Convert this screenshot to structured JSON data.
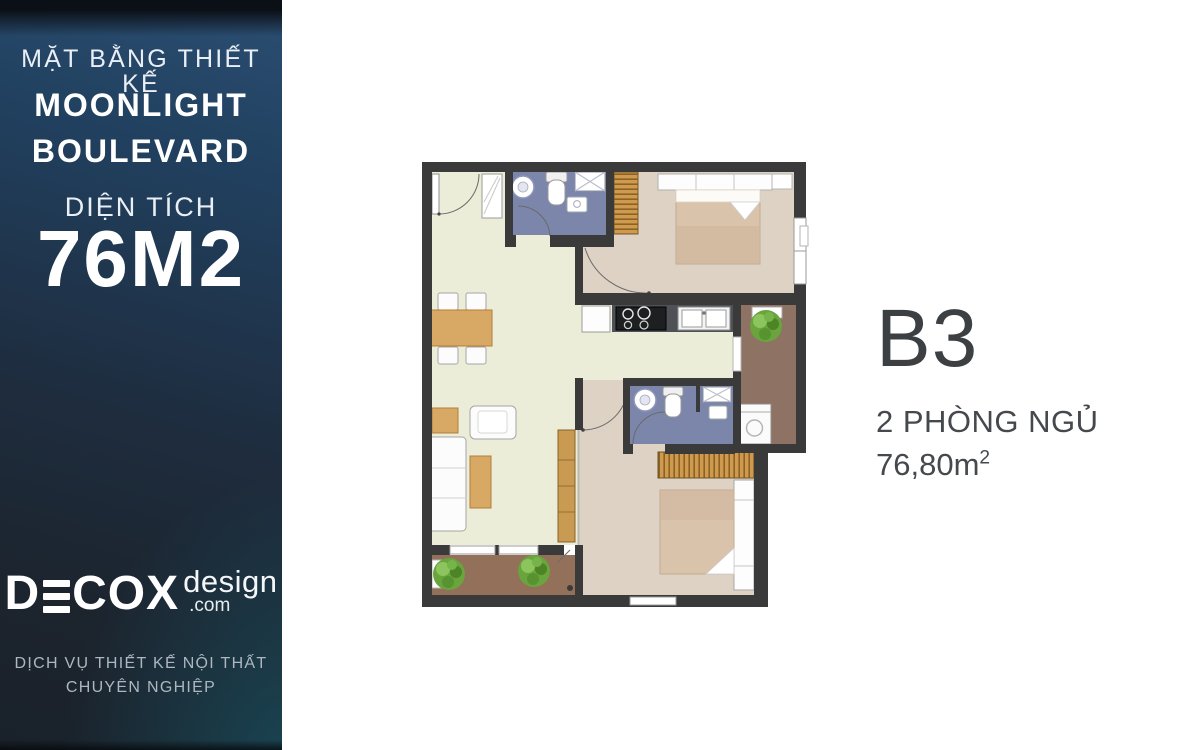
{
  "sidebar": {
    "subtitle": "MẶT BẰNG THIẾT KẾ",
    "title_line1": "MOONLIGHT",
    "title_line2": "BOULEVARD",
    "area_label": "DIỆN TÍCH",
    "area_value": "76M2",
    "logo": {
      "full": "DECOX",
      "part1": "D",
      "part2": "COX",
      "suffix": "design",
      "domain": ".com"
    },
    "tagline_line1": "DỊCH VỤ THIẾT KẾ NỘI THẤT",
    "tagline_line2": "CHUYÊN NGHIỆP",
    "colors": {
      "background_top": "#2b4e72",
      "background_bottom": "#1a212a",
      "teal_glow": "#195f71",
      "text": "#ffffff",
      "tagline_text": "#aeb7bf"
    }
  },
  "unit_info": {
    "code": "B3",
    "bedrooms": "2 PHÒNG NGỦ",
    "area": "76,80m",
    "area_superscript": "2",
    "text_color": "#3e4245"
  },
  "floor_plan": {
    "type": "apartment-2-bedroom-floor-plan",
    "colors": {
      "wall": "#3a3a3a",
      "living_floor": "#ecedd9",
      "bedroom_floor": "#ded2c5",
      "bathroom_floor": "#7c86aa",
      "balcony_floor_left": "#93705a",
      "balcony_floor_right": "#8e7263",
      "wood": "#d2a261",
      "counter": "#4e5257",
      "plant": "#69a43d",
      "fixture": "#ffffff"
    }
  }
}
